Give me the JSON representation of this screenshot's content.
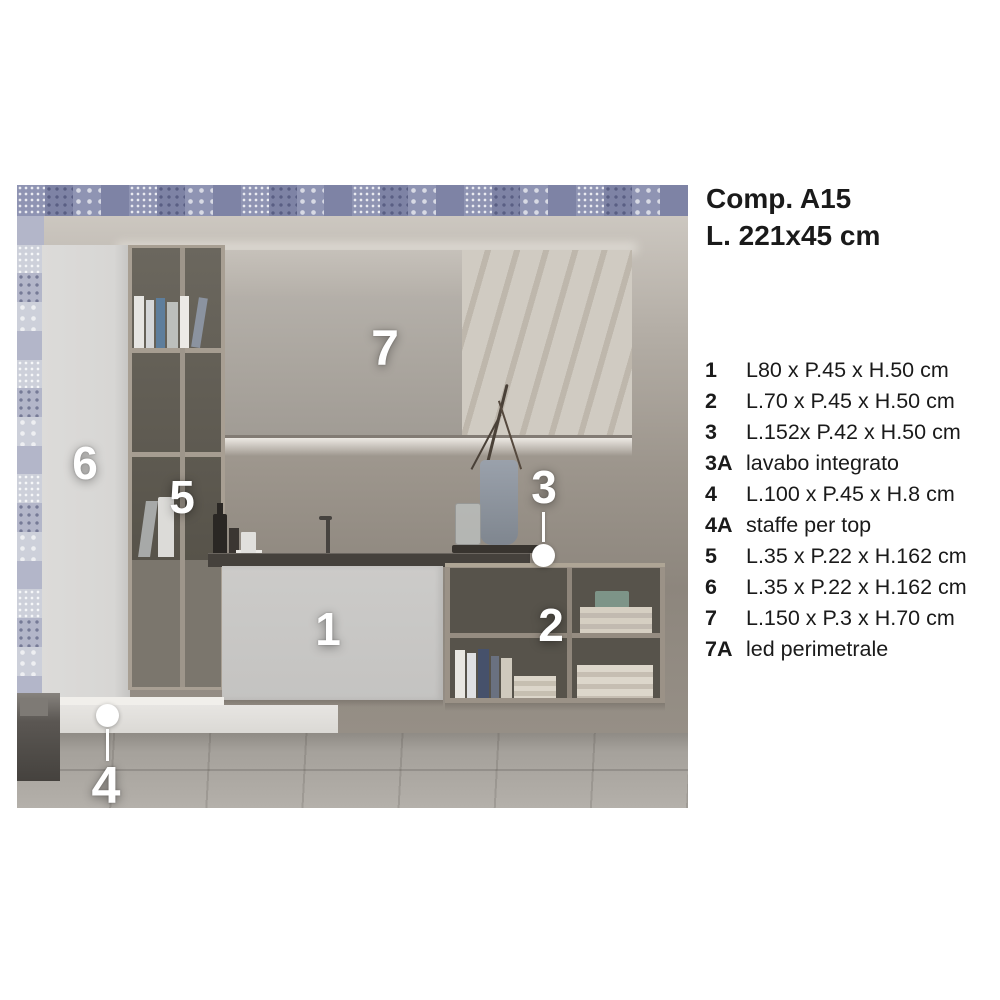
{
  "panel": {
    "title_line1": "Comp. A15",
    "title_line2": "L. 221x45 cm",
    "specs": [
      {
        "code": "1",
        "desc": "L80 x P.45 x H.50 cm"
      },
      {
        "code": "2",
        "desc": "L.70 x P.45 x H.50 cm"
      },
      {
        "code": "3",
        "desc": "L.152x P.42 x H.50 cm"
      },
      {
        "code": "3A",
        "desc": "lavabo integrato"
      },
      {
        "code": "4",
        "desc": "L.100 x P.45 x H.8 cm"
      },
      {
        "code": "4A",
        "desc": "staffe per top"
      },
      {
        "code": "5",
        "desc": "L.35 x P.22 x H.162 cm"
      },
      {
        "code": "6",
        "desc": "L.35 x P.22 x H.162 cm"
      },
      {
        "code": "7",
        "desc": "L.150 x P.3 x H.70 cm"
      },
      {
        "code": "7A",
        "desc": "led perimetrale"
      }
    ]
  },
  "photo": {
    "markers": {
      "m1": "1",
      "m2": "2",
      "m3": "3",
      "m4": "4",
      "m5": "5",
      "m6": "6",
      "m7": "7"
    },
    "tile_palette": [
      "#8f94b3",
      "#c7c9d6",
      "#6d7296",
      "#b3b6c9",
      "#dcdde3",
      "#7e83a5",
      "#a4a8c0",
      "#51567c",
      "#cdd0da",
      "#9aa0ba"
    ],
    "colors": {
      "wall": "#9d968d",
      "cabinet": "#d7d6d4",
      "shelf_frame": "#a89f93",
      "shelf_interior": "#57534a",
      "vanity": "#c8c7c5",
      "counter": "#45413c",
      "bench": "#e7e5e2",
      "floor": "#a5a19b",
      "marker": "#ffffff",
      "text": "#1a1a1a"
    }
  }
}
